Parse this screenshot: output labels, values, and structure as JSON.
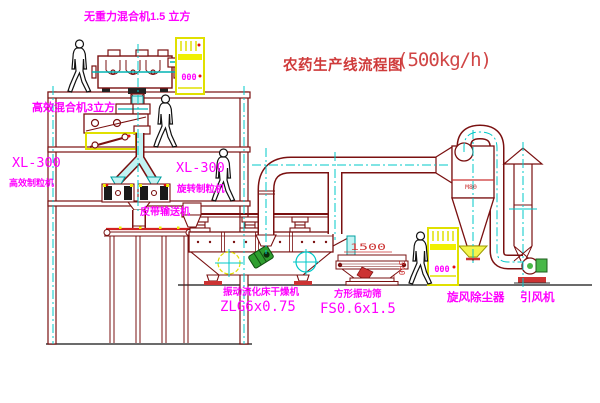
{
  "title": {
    "name": "农药生产线流程图",
    "capacity": "(500kg/h)"
  },
  "labels": {
    "gravity_mixer": "无重力混合机1.5 立方",
    "high_eff_mixer": "高效混合机3立方",
    "granulator_left_model": "XL-300",
    "granulator_left_name": "高效制粒机",
    "granulator_mid_model": "XL-300",
    "granulator_mid_name": "旋转制粒机",
    "belt_conveyor": "皮带输送机",
    "fluid_bed_dryer_name": "振动流化床干燥机",
    "fluid_bed_dryer_model": "ZLG6x0.75",
    "vibrating_screen_name": "方形振动筛",
    "vibrating_screen_model": "FS0.6x1.5",
    "cyclone": "旋风除尘器",
    "induced_draft_fan": "引风机"
  },
  "annotations": {
    "screen_width_dim": "1500",
    "screen_height_dim": "340",
    "cyclone_mark": "M80",
    "cabinet_mark_top": "000",
    "cabinet_mark_right": "000"
  },
  "colors": {
    "linework": "#7a1010",
    "label_magenta": "#ff00ff",
    "pipe_cyan": "#00c8c8",
    "highlight_yellow": "#f0f000",
    "title_red": "#cf3a3a",
    "drum_green": "#2f9e2f"
  }
}
